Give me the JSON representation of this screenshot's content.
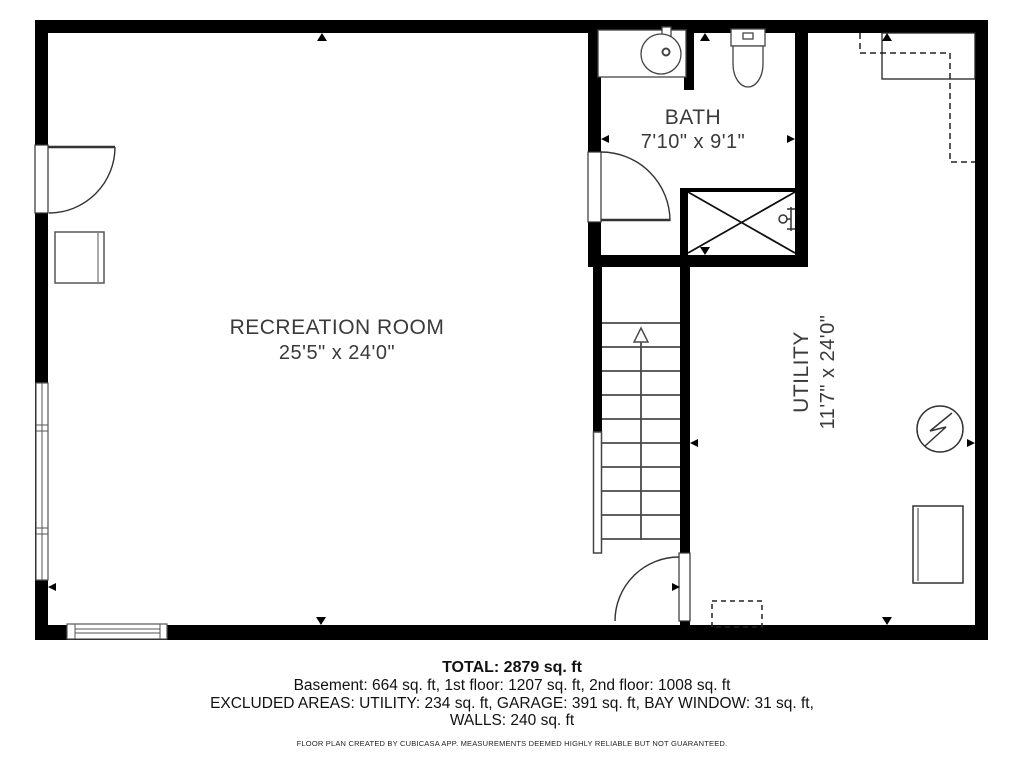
{
  "title": "Basement floor plan",
  "colors": {
    "wall": "#000000",
    "line": "#3d3d3d",
    "text": "#3a3a3a"
  },
  "rooms": {
    "recreation": {
      "name": "RECREATION ROOM",
      "dimensions": "25'5\" x 24'0\""
    },
    "bath": {
      "name": "BATH",
      "dimensions": "7'10\" x 9'1\""
    },
    "utility": {
      "name": "UTILITY",
      "dimensions": "11'7\" x 24'0\""
    }
  },
  "fixtures": [
    "entry-door",
    "bath-door",
    "stairs-door",
    "sink-vanity",
    "toilet",
    "shower",
    "staircase-up",
    "water-heater",
    "appliance",
    "cabinet",
    "window-left",
    "window-bottom"
  ],
  "footer": {
    "total": "TOTAL: 2879 sq. ft",
    "floors": "Basement: 664 sq. ft, 1st floor: 1207 sq. ft, 2nd floor: 1008 sq. ft",
    "excluded_line1": "EXCLUDED AREAS: UTILITY: 234 sq. ft, GARAGE: 391 sq. ft, BAY WINDOW: 31 sq. ft,",
    "excluded_line2": "WALLS: 240 sq. ft",
    "disclaimer": "FLOOR PLAN CREATED BY CUBICASA APP. MEASUREMENTS DEEMED HIGHLY RELIABLE BUT NOT GUARANTEED."
  }
}
